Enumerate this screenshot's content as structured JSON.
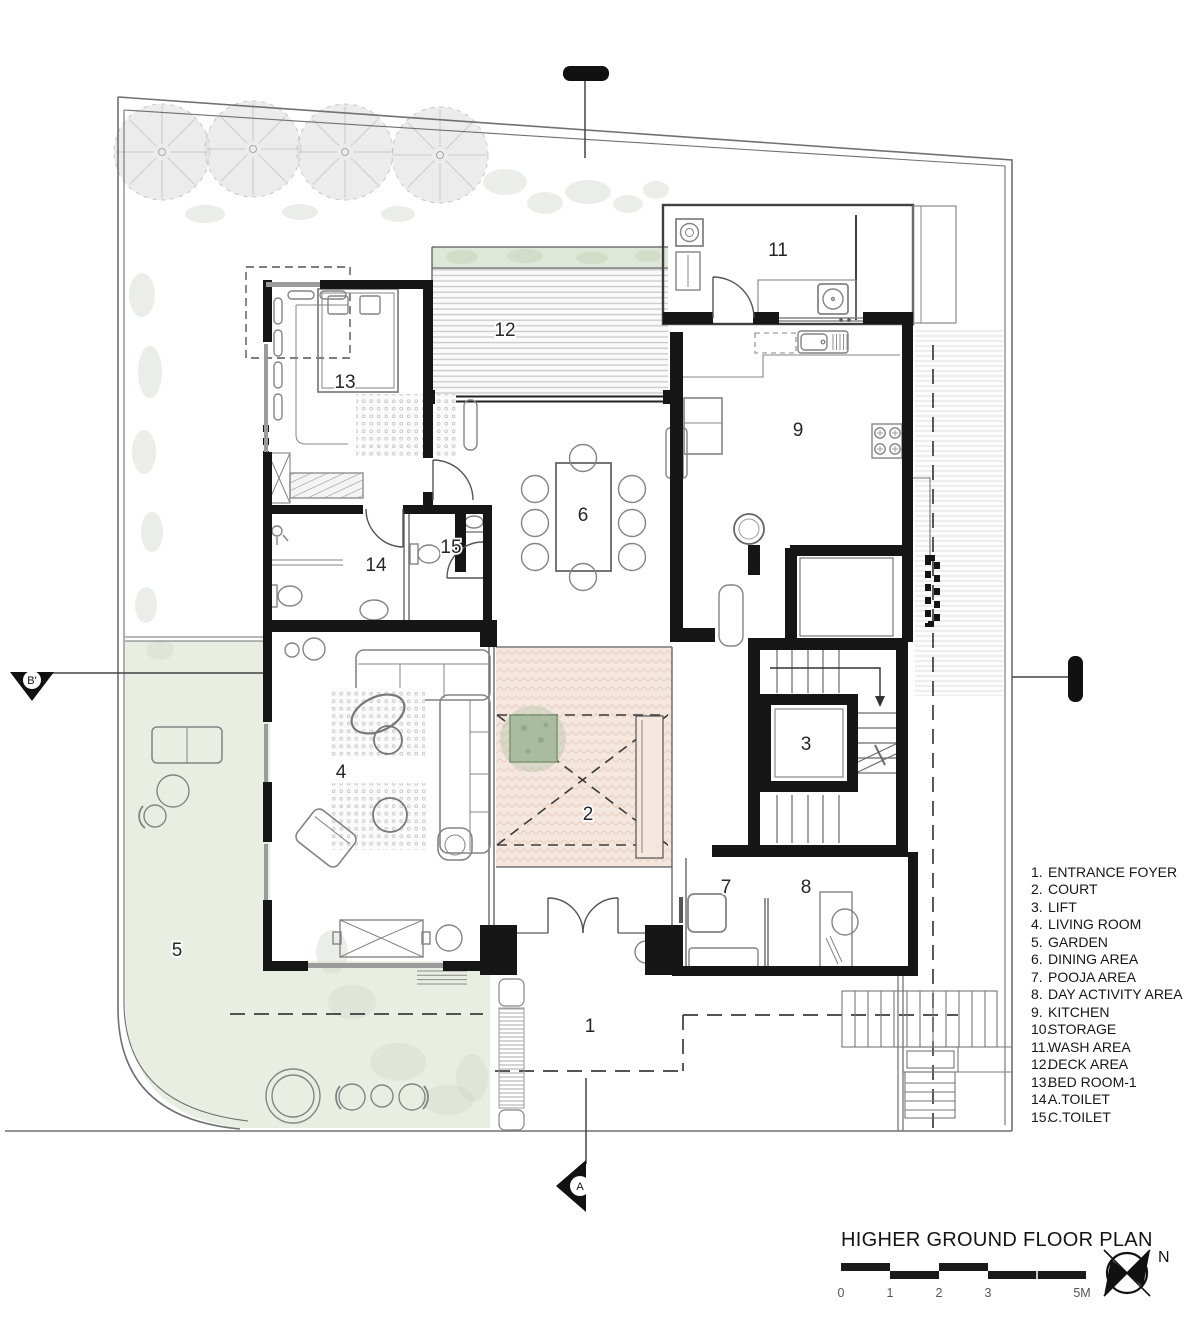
{
  "title_block": {
    "title": "HIGHER GROUND FLOOR PLAN",
    "north_label": "N",
    "scale_ticks": [
      "0",
      "1",
      "2",
      "3",
      "5M"
    ]
  },
  "section_markers": {
    "left": "B'",
    "bottom": "A"
  },
  "legend": {
    "items": [
      {
        "num": "1.",
        "label": "ENTRANCE FOYER"
      },
      {
        "num": "2.",
        "label": "COURT"
      },
      {
        "num": "3.",
        "label": "LIFT"
      },
      {
        "num": "4.",
        "label": "LIVING ROOM"
      },
      {
        "num": "5.",
        "label": "GARDEN"
      },
      {
        "num": "6.",
        "label": "DINING AREA"
      },
      {
        "num": "7.",
        "label": "POOJA AREA"
      },
      {
        "num": "8.",
        "label": "DAY ACTIVITY AREA"
      },
      {
        "num": "9.",
        "label": "KITCHEN"
      },
      {
        "num": "10.",
        "label": "STORAGE"
      },
      {
        "num": "11.",
        "label": "WASH AREA"
      },
      {
        "num": "12.",
        "label": "DECK AREA"
      },
      {
        "num": "13.",
        "label": "BED ROOM-1"
      },
      {
        "num": "14.",
        "label": "A.TOILET"
      },
      {
        "num": "15.",
        "label": "C.TOILET"
      }
    ]
  },
  "room_labels": [
    {
      "number": "1",
      "name": "entrance-foyer"
    },
    {
      "number": "2",
      "name": "court"
    },
    {
      "number": "3",
      "name": "lift"
    },
    {
      "number": "4",
      "name": "living-room"
    },
    {
      "number": "5",
      "name": "garden"
    },
    {
      "number": "6",
      "name": "dining-area"
    },
    {
      "number": "7",
      "name": "pooja-area"
    },
    {
      "number": "8",
      "name": "day-activity-area"
    },
    {
      "number": "9",
      "name": "kitchen"
    },
    {
      "number": "11",
      "name": "wash-area"
    },
    {
      "number": "12",
      "name": "deck-area"
    },
    {
      "number": "13",
      "name": "bed-room-1"
    },
    {
      "number": "14",
      "name": "a-toilet"
    },
    {
      "number": "15",
      "name": "c-toilet"
    }
  ],
  "colors": {
    "wall": "#161616",
    "court_fill": "#f5e7de",
    "court_pattern": "#e9d2c5",
    "garden_fill": "#e9eee3",
    "planter_green": "#a9bc9f",
    "deck_stripe": "#c9c9c9",
    "line": "#555555",
    "paper": "#ffffff"
  }
}
